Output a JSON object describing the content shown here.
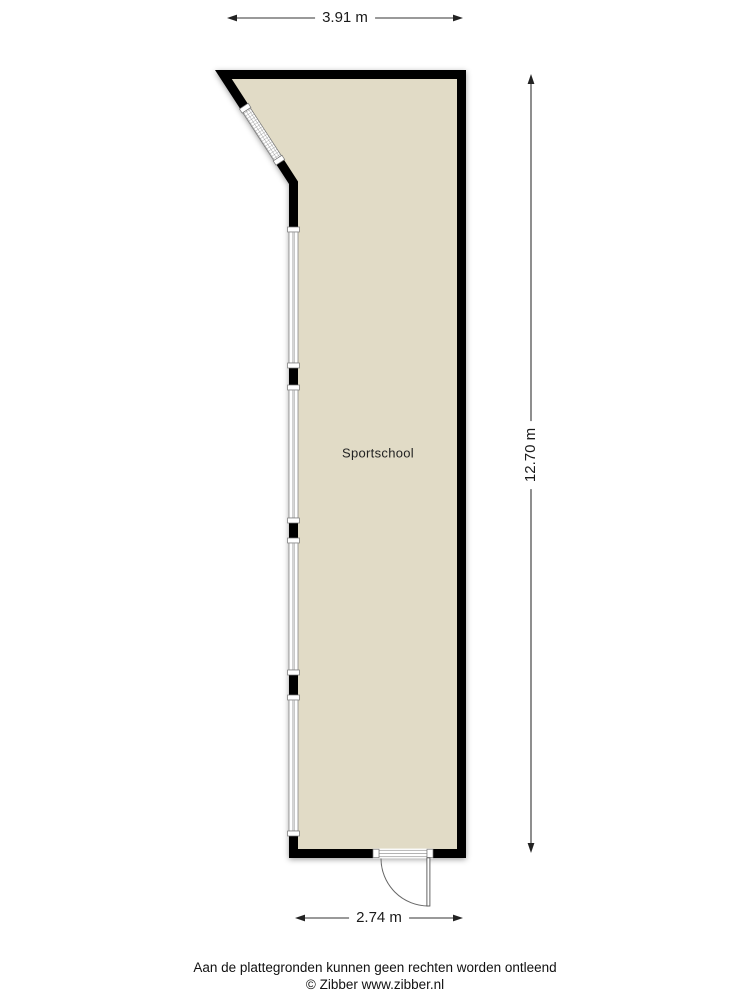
{
  "plan": {
    "room_label": "Sportschool",
    "dimensions": {
      "top_label": "3.91 m",
      "right_label": "12.70 m",
      "bottom_label": "2.74 m"
    },
    "features": [
      "diagonal-window",
      "left-wall-windows",
      "entry-door"
    ]
  },
  "footer": {
    "disclaimer": "Aan de plattegronden kunnen geen rechten worden ontleend",
    "credit": "© Zibber www.zibber.nl"
  },
  "colors": {
    "wall": "#000000",
    "floor": "#e1dbc6",
    "background": "#ffffff",
    "dimension_line": "#333333",
    "text": "#1a1a1a",
    "window_frame": "#8a8a8a"
  }
}
